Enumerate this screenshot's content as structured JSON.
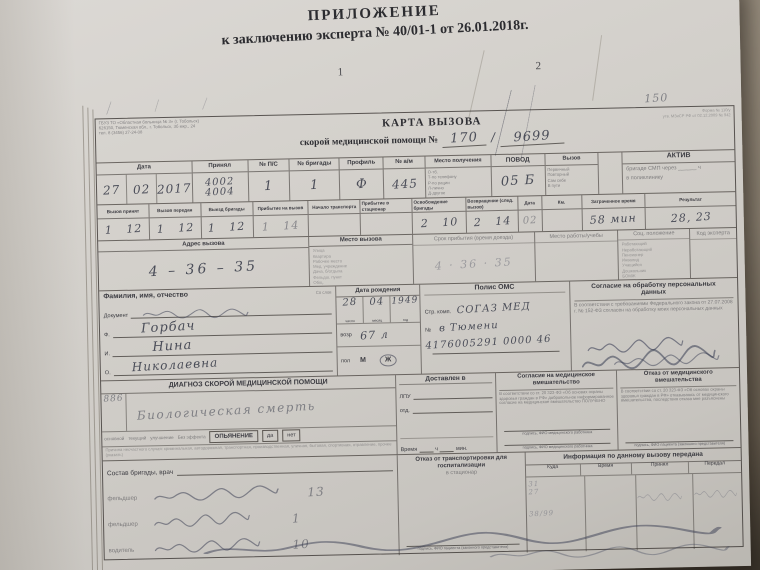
{
  "header": {
    "title": "ПРИЛОЖЕНИЕ",
    "subtitle": "к заключению эксперта № 40/01-1 от 26.01.2018г.",
    "page1": "1",
    "page2": "2"
  },
  "org": {
    "l1": "ГБУЗ ТО «Областная больница № 3» (г. Тобольск)",
    "l2": "626150, Тюменская обл., г. Тобольск, 3б мкр., 24",
    "l3": "тел. 8 (3456) 27-24-08"
  },
  "meta": {
    "l1": "Форма № 110/у",
    "l2": "утв. МЗиСР РФ от 02.12.2009 № 942",
    "hw_note": "150"
  },
  "title": {
    "t1": "КАРТА ВЫЗОВА",
    "t2": "скорой медицинской помощи №",
    "num1": "170",
    "sep": "/",
    "num2": "9699"
  },
  "r1": {
    "date_label": "Дата",
    "date_d": "27",
    "date_m": "02",
    "date_y": "2017",
    "recv_label": "Принял",
    "recv_v1": "4002",
    "recv_v2": "4004",
    "ps_label": "№ П/С",
    "ps_value": "1",
    "brig_label": "№ бригады",
    "brig_value": "1",
    "prof_label": "Профиль",
    "prof_value": "Ф",
    "car_label": "№ а/м",
    "car_value": "445",
    "src_label": "Место получения",
    "src_opts": [
      "О-тб.",
      "Т-по телефону",
      "Р-по рации",
      "Л-лично",
      "Д-другое"
    ],
    "povod_label": "ПОВОД",
    "povod_value": "05 Б",
    "call_label": "Вызов",
    "call_opts": [
      "Первичный",
      "Повторный",
      "Сам себе",
      "В пути"
    ],
    "aktiv_label": "АКТИВ",
    "aktiv_l1": "бригаде СМП через ______ ч",
    "aktiv_l2": "в поликлинику"
  },
  "r2": {
    "cells": [
      {
        "label": "Вызов принят",
        "value": "1   12"
      },
      {
        "label": "Вызов передан",
        "value": "1   12"
      },
      {
        "label": "Выезд бригады",
        "value": "1   12"
      },
      {
        "label": "Прибытие на вызов",
        "value": "1   14"
      },
      {
        "label": "Начало транспорта",
        "value": ""
      },
      {
        "label": "Прибытие в стационар",
        "value": ""
      },
      {
        "label": "Освобождение бригады",
        "value": "2   10"
      },
      {
        "label": "Возвращение (след. вызов)",
        "value": "2   14"
      },
      {
        "label": "Дата",
        "value": "02"
      },
      {
        "label": "Км.",
        "value": ""
      },
      {
        "label": "Затраченное время",
        "value": "58 мин"
      },
      {
        "label": "Результат",
        "value": "28, 23"
      }
    ]
  },
  "r3": {
    "addr_label": "Адрес вызова",
    "addr_value": "4 – 36 – 35",
    "place_label": "Место вызова",
    "place_opts": [
      "Улица",
      "Квартира",
      "Рабочее место",
      "Мед. учреждение",
      "Дача, б/отдыха",
      "Фельдш. пункт",
      "Общ."
    ],
    "term_label": "Срок прибытия (время доезда)",
    "term_value": "4 · 36 · 35",
    "work_label": "Место работы/учебы",
    "soc_label": "Соц. положение",
    "soc_opts": [
      "Работающий",
      "Неработающий",
      "Пенсионер",
      "Инвалид",
      "Учащийся",
      "Дошкольник",
      "БОМЖ"
    ],
    "expert_label": "Код эксперта"
  },
  "r4": {
    "fio_label": "Фамилия, имя, отчество",
    "fio_note": "Со слов",
    "doc_label": "Документ",
    "f_label": "Ф.",
    "f_value": "Горбач",
    "i_label": "И.",
    "i_value": "Нина",
    "o_label": "О.",
    "o_value": "Николаевна",
    "birth_label": "Дата рождения",
    "birth_d": "28",
    "birth_m": "04",
    "birth_y": "1949",
    "cap_d": "число",
    "cap_m": "месяц",
    "cap_y": "год",
    "age_label": "возр",
    "age_value": "67 л",
    "sex_label": "пол",
    "sex_m": "М",
    "sex_f": "Ж",
    "polis_label": "Полис ОМС",
    "ins_label": "Стр. комп.",
    "ins_value": "СОГАЗ МЕД",
    "num_label": "№",
    "num_value": "в Тюмени",
    "polis_number": "4176005291 0000 46",
    "consent_label": "Согласие на обработку персональных данных",
    "consent_text": "В соответствии с требованиями Федерального закона от 27.07.2008 г. № 152-ФЗ согласен на обработку моих персональных данных"
  },
  "r5": {
    "diag_label": "ДИАГНОЗ СКОРОЙ МЕДИЦИНСКОЙ ПОМОЩИ",
    "diag_code": "886",
    "diag_value": "Биологическая смерть",
    "deliv_label": "Доставлен в",
    "lpu_label": "ЛПУ",
    "otd_label": "отд.",
    "time_label": "Время",
    "h_label": "ч",
    "min_label": "мин.",
    "consent_label": "Согласие на медицинское вмешательство",
    "consent_text": "В соответствии со ст. 20 323-ФЗ «Об основах охраны здоровья граждан в РФ» добровольное информированное согласие на медицинское вмешательство ПОЛУЧЕНО",
    "consent_sign": "подпись, ФИО медицинского работника",
    "refuse_label": "Отказ от медицинского вмешательства",
    "refuse_text": "В соответствии со ст. 20 323-ФЗ «Об основах охраны здоровья граждан в РФ» отказываюсь от медицинского вмешательства, последствия отказа мне разъяснены",
    "refuse_sign": "подпись, ФИО пациента (законного представителя)",
    "res_words": [
      "основной",
      "текущий",
      "улучшение",
      "Без эффекта"
    ],
    "intox_label": "ОПЬЯНЕНИЕ",
    "yes": "да",
    "no": "нет",
    "cause_text": "Причина несчастного случая: криминальная, автодорожная, транспортная, производственная, уличная, бытовая, спортивная, отравление, прочее (указать)"
  },
  "r6": {
    "crew_label": "Состав бригады, врач",
    "crew_rows": [
      {
        "role": "фельдшер",
        "num": "13"
      },
      {
        "role": "фельдшер",
        "num": "1"
      },
      {
        "role": "водитель",
        "num": "10"
      }
    ],
    "refuse_label": "Отказ от транспортировки для госпитализации",
    "refuse_sub": "в стационар",
    "refuse_sign": "подпись, ФИО пациента (законного представителя)",
    "info_label": "Информация по данному вызову передана",
    "info_cols": [
      "Куда",
      "Время",
      "Принял",
      "Передал"
    ],
    "faint": [
      "31",
      "27",
      "38/99"
    ]
  }
}
